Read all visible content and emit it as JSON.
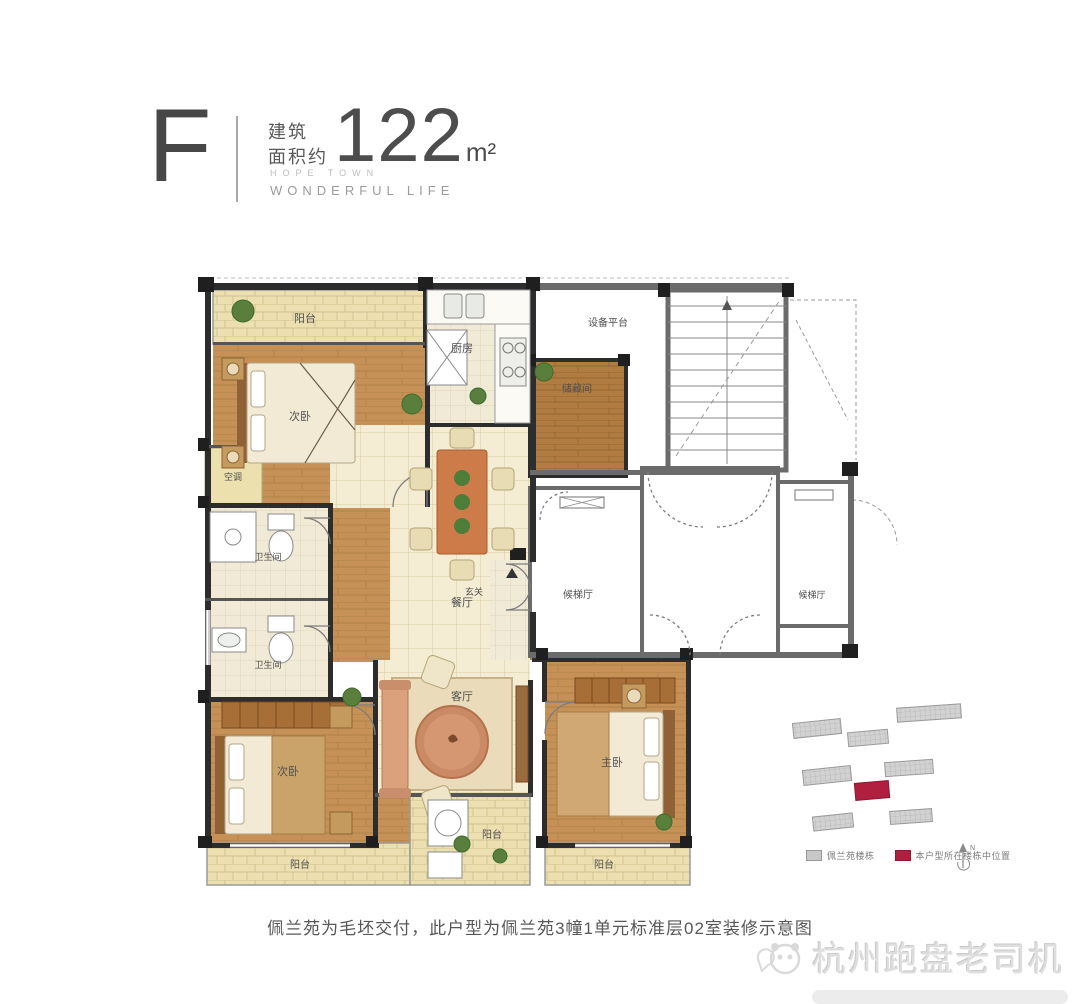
{
  "header": {
    "type_letter": "F",
    "area_label_line1": "建筑",
    "area_label_line2": "面积约",
    "area_value": "122",
    "area_unit": "m²",
    "tagline1": "HOPE TOWN",
    "tagline2": "WONDERFUL LIFE"
  },
  "floorplan": {
    "rooms": {
      "balcony_top": "阳台",
      "bedroom_top": "次卧",
      "ac": "空调",
      "bath_upper": "卫生间",
      "bath_lower": "卫生间",
      "kitchen": "厨房",
      "dining": "餐厅",
      "storage": "储藏间",
      "equipment": "设备平台",
      "lobby": "候梯厅",
      "lobby2": "候梯厅",
      "foyer": "玄关",
      "living": "客厅",
      "bedroom_left": "次卧",
      "master": "主卧",
      "balcony_left": "阳台",
      "balcony_mid": "阳台",
      "balcony_master": "阳台"
    }
  },
  "siteplan": {
    "legend": [
      {
        "label": "佩兰苑楼栋",
        "color": "#c8c8c8"
      },
      {
        "label": "本户型所在楼栋中位置",
        "color": "#b01f3f"
      }
    ],
    "compass": "N"
  },
  "caption": "佩兰苑为毛坯交付，此户型为佩兰苑3幢1单元标准层02室装修示意图",
  "watermark": {
    "name": "杭州跑盘老司机"
  },
  "colors": {
    "wall": "#2d2d2d",
    "core_wall": "#6b6b6b",
    "wood": "#c59157",
    "tile": "#f4ecd3",
    "balcony": "#ece0b0",
    "accent": "#cd7c49",
    "site_red": "#b01f3f",
    "site_gray": "#c8c8c8"
  }
}
